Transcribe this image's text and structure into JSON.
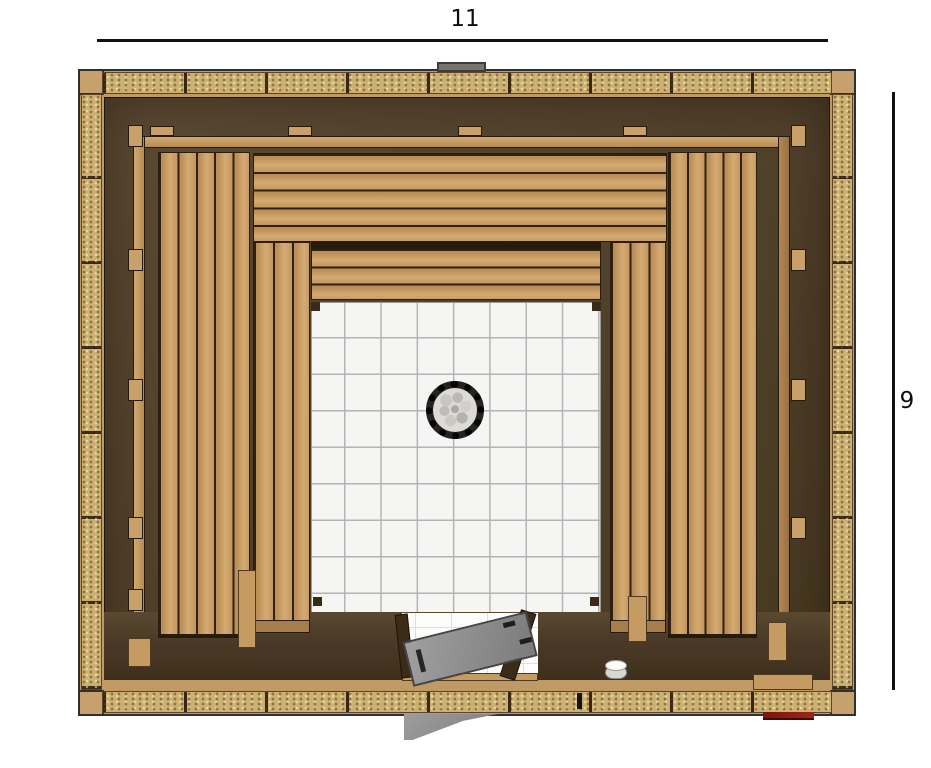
{
  "dimensions": {
    "width_label": "11",
    "height_label": "9"
  },
  "palette": {
    "bench_wood": "#c79c63",
    "frame_wood": "#bf9a67",
    "wall_dark": "#52422c",
    "insulation": "#cdb173",
    "tile": "#f5f5f3",
    "tile_grid": "#b4b4b4",
    "door_glass": "#8d8d8d",
    "accent_red": "#9c2018",
    "dimension_line": "#111111"
  },
  "structure": {
    "insulation_panels_top": 9,
    "insulation_panels_bottom": 9,
    "insulation_panels_left": 7,
    "insulation_panels_right": 7,
    "bench_slats_left_upper": 5,
    "bench_slats_left_lower": 3,
    "bench_slats_right_upper": 5,
    "bench_slats_right_lower": 3,
    "bench_slats_top_upper": 5,
    "bench_slats_top_lower": 3
  }
}
